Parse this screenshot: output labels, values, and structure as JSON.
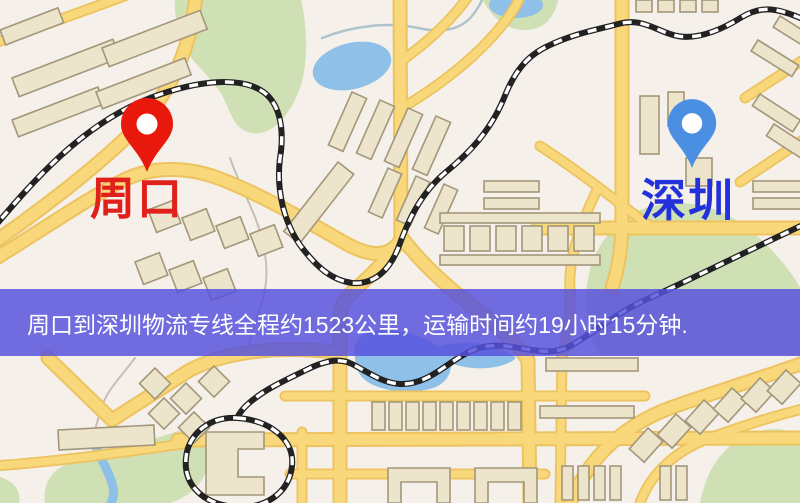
{
  "map": {
    "markers": [
      {
        "id": "origin",
        "city": "周口",
        "pin_color": "#e8180d",
        "label_color": "#e0201a",
        "pin_style": "red-teardrop-pin"
      },
      {
        "id": "destination",
        "city": "深圳",
        "pin_color": "#4a8fe2",
        "label_color": "#2231da",
        "pin_style": "blue-teardrop-pin"
      }
    ],
    "colors": {
      "land": "#f6f0ea",
      "road_fill": "#f8d87a",
      "road_casing": "#ecc35f",
      "building_fill": "#ece4cb",
      "building_outline": "#a3977b",
      "park": "#cfe0b5",
      "water": "#8fc0e8",
      "railway": "#222222"
    }
  },
  "banner": {
    "text": "周口到深圳物流专线全程约1523公里，运输时间约19小时15分钟.",
    "background": "#5651dc",
    "text_color": "#ffffff",
    "route": {
      "origin": "周口",
      "destination": "深圳",
      "distance_km": 1523,
      "duration_text": "19小时15分钟"
    }
  }
}
